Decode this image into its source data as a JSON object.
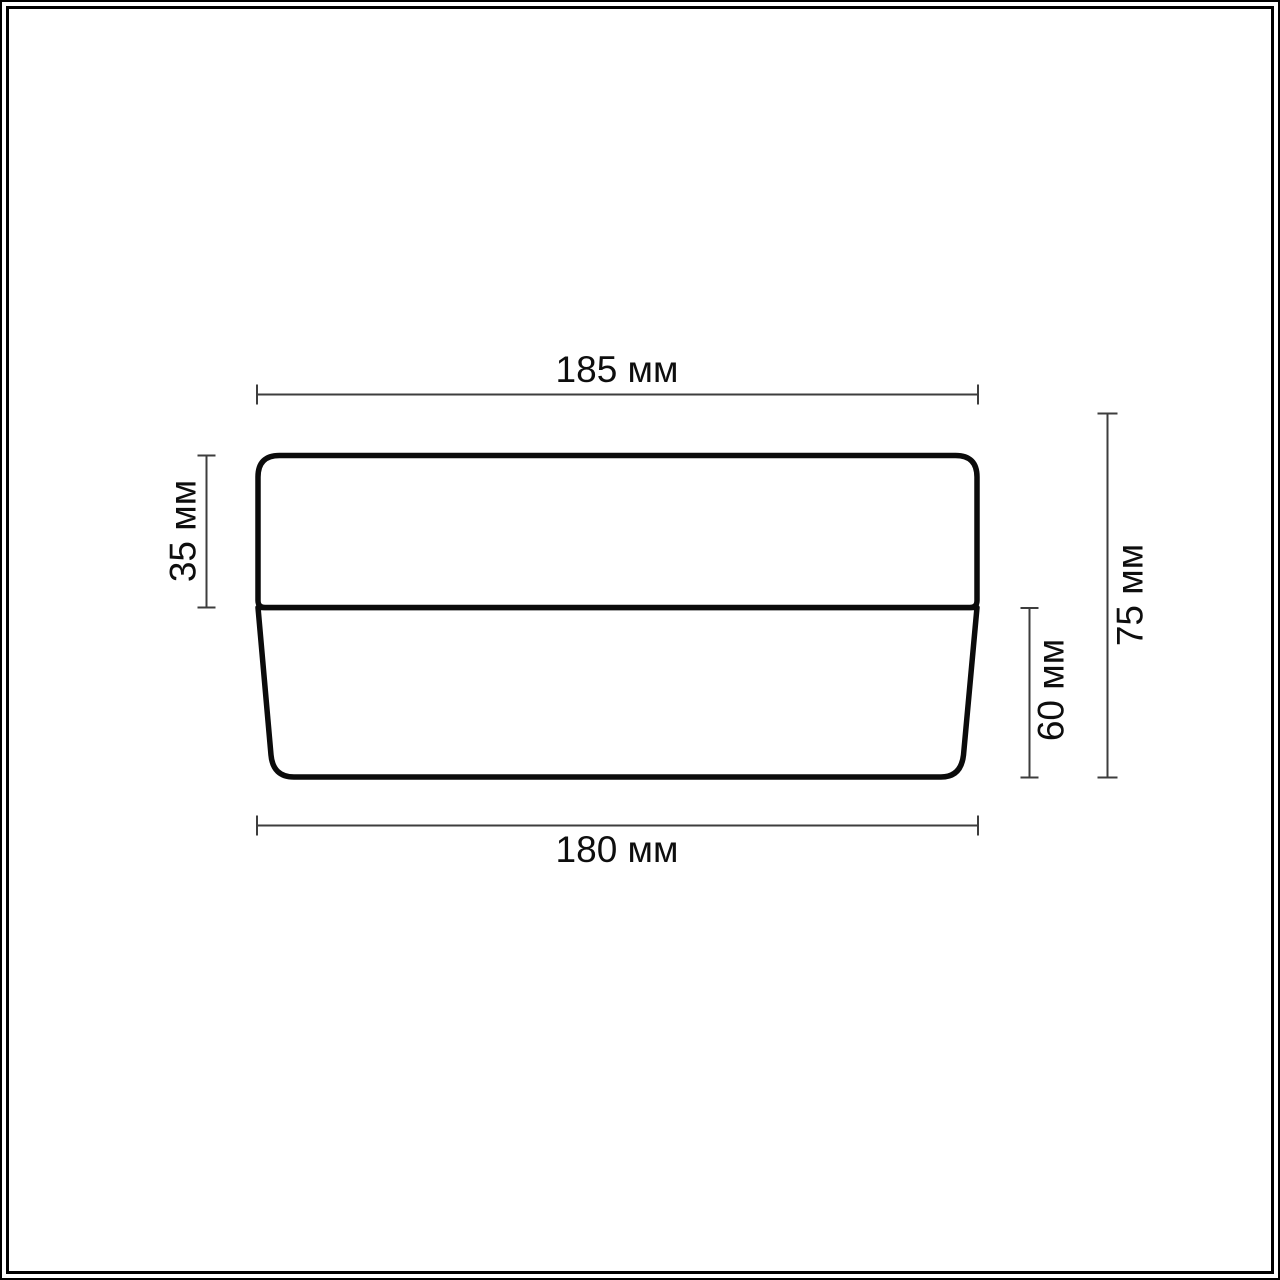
{
  "page": {
    "background_color": "#ffffff",
    "frame_color": "#000000"
  },
  "diagram": {
    "object_stroke_color": "#0b0b0b",
    "dimension_line_color": "#3d3d3d",
    "label_color": "#0e0e0e",
    "unit": "мм",
    "dimensions": {
      "top_width": {
        "label": "185 мм",
        "value": 185,
        "unit": "мм"
      },
      "upper_section_height": {
        "label": "35 мм",
        "value": 35,
        "unit": "мм"
      },
      "lower_section_height": {
        "label": "60 мм",
        "value": 60,
        "unit": "мм"
      },
      "total_height": {
        "label": "75 мм",
        "value": 75,
        "unit": "мм"
      },
      "bottom_width": {
        "label": "180 мм",
        "value": 180,
        "unit": "мм"
      }
    }
  }
}
